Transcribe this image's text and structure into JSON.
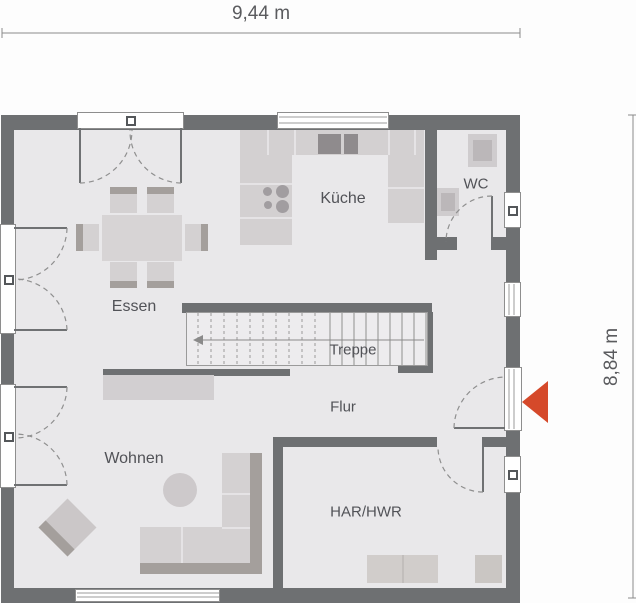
{
  "plan": {
    "type": "residential-ground-floor-plan",
    "dimension_labels": {
      "width": "9,44 m",
      "height": "8,84 m"
    },
    "room_labels": {
      "essen": "Essen",
      "kueche": "Küche",
      "wc": "WC",
      "treppe": "Treppe",
      "flur": "Flur",
      "wohnen": "Wohnen",
      "har_hwr": "HAR/HWR"
    },
    "colors": {
      "wall": "#6e7072",
      "floor": "#e9e8ea",
      "furniture": "#d4d1d2",
      "furniture_dark": "#a49f9c",
      "entrance_arrow": "#d5492a",
      "label_text": "#515257",
      "dimension_text": "#5a5b5e"
    },
    "icons": {
      "entrance_arrow": "left-pointing-triangle"
    }
  }
}
